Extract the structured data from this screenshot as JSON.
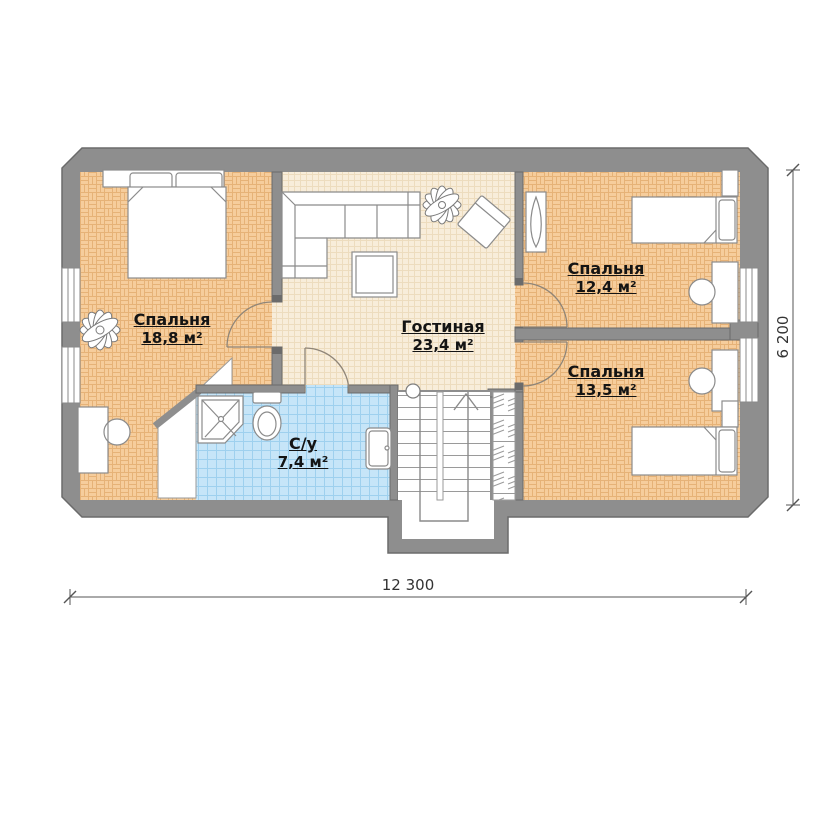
{
  "plan": {
    "rooms": [
      {
        "name": "Спальня",
        "area": "18,8 м²"
      },
      {
        "name": "Гостиная",
        "area": "23,4 м²"
      },
      {
        "name": "Спальня",
        "area": "12,4 м²"
      },
      {
        "name": "Спальня",
        "area": "13,5 м²"
      },
      {
        "name": "С/у",
        "area": "7,4 м²"
      }
    ],
    "dimensions": {
      "width": "12 300",
      "height": "6 200"
    },
    "colors": {
      "wall": "#8e8e8e",
      "wall_edge": "#6b6b6b",
      "parquet_floor": "#f6cd9c",
      "living_floor": "#f8edda",
      "bath_tile": "#c6e5f8",
      "furniture_fill": "#ffffff",
      "furniture_stroke": "#8b8b8b"
    }
  }
}
